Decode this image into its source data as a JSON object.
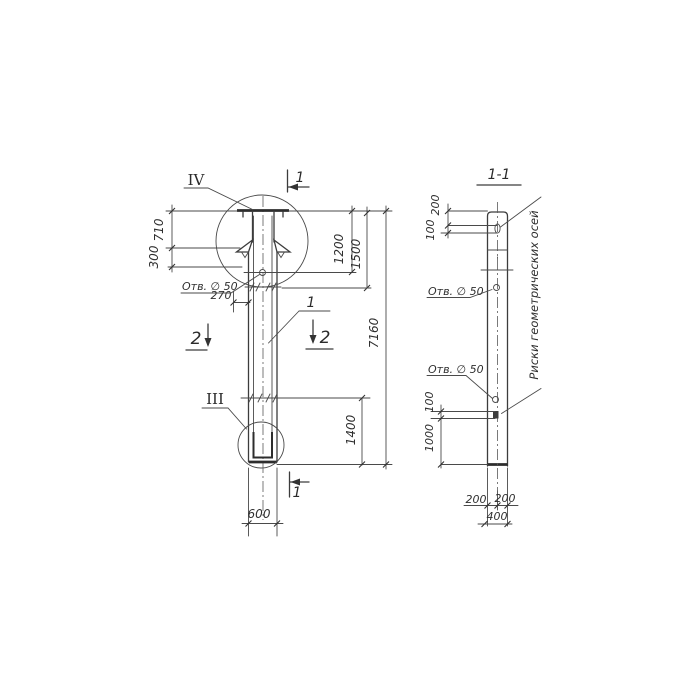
{
  "drawing_type": "technical drawing, scanned hand-drawn pole / column views",
  "colors": {
    "background": "#ffffff",
    "line": "#4a4a4a",
    "text": "#2f2f2f"
  },
  "front": {
    "detail_marker_top": "IV",
    "detail_marker_bottom": "III",
    "section_mark_1_top": "1",
    "section_mark_1_bottom": "1",
    "section_mark_2_left": "2",
    "section_mark_2_right": "2",
    "part_number": "1",
    "hole_label": "Отв. ∅ 50",
    "dims": {
      "cap_height": "710",
      "neck_to_hole": "300",
      "edge_offset": "270",
      "top_to_hole": "1200",
      "top_to_joint": "1500",
      "overall_length": "7160",
      "bottom_segment": "1400",
      "width": "600"
    }
  },
  "section": {
    "title": "1-1",
    "hole_label_upper": "Отв. ∅ 50",
    "hole_label_lower": "Отв. ∅ 50",
    "axes_note": "Риски геометрических осей",
    "dims": {
      "top_to_slot": "200",
      "slot_height_upper": "100",
      "slot_height_lower": "100",
      "slot_to_bottom": "1000",
      "half_width_left": "200",
      "half_width_right": "200",
      "depth": "400"
    }
  }
}
